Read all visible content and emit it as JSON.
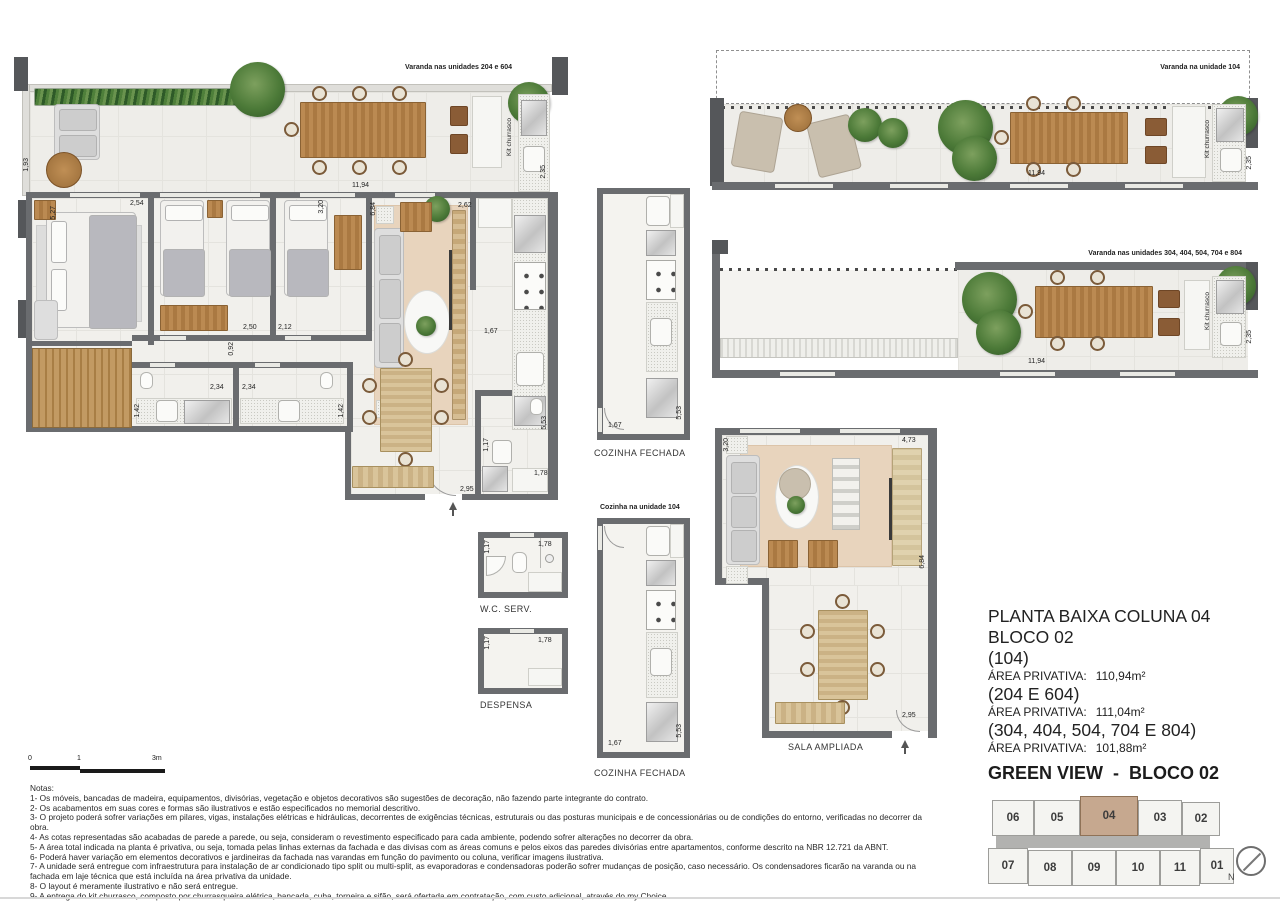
{
  "document": {
    "title_lines": [
      "PLANTA BAIXA COLUNA 04",
      "BLOCO 02"
    ],
    "units": [
      {
        "name": "(104)",
        "area_label": "ÁREA PRIVATIVA:",
        "area": "110,94m²"
      },
      {
        "name": "(204 E 604)",
        "area_label": "ÁREA PRIVATIVA:",
        "area": "111,04m²"
      },
      {
        "name": "(304, 404, 504, 704 E 804)",
        "area_label": "ÁREA PRIVATIVA:",
        "area": "101,88m²"
      }
    ],
    "project_name": "GREEN VIEW  -  BLOCO 02"
  },
  "plan_labels": {
    "varanda_204_604": "Varanda nas unidades 204 e 604",
    "varanda_104": "Varanda na unidade 104",
    "varanda_304_804": "Varanda nas unidades 304, 404, 504, 704 e 804",
    "kit_churrasco": "Kit churrasco",
    "cozinha_fechada": "COZINHA FECHADA",
    "cozinha_104": "Cozinha na unidade 104",
    "wc_serv": "W.C. SERV.",
    "despensa": "DESPENSA",
    "sala_ampliada": "SALA AMPLIADA"
  },
  "dims": {
    "main": [
      "1,93",
      "5,27",
      "2,54",
      "3,20",
      "11,94",
      "6,84",
      "2,62",
      "2,35",
      "2,50",
      "2,12",
      "0,92",
      "1,67",
      "2,34",
      "2,34",
      "1,42",
      "1,42",
      "5,53",
      "1,17",
      "1,78",
      "2,95"
    ],
    "balcony_104": [
      "11,94",
      "2,35"
    ],
    "balcony_304": [
      "11,94",
      "2,35"
    ],
    "kitchen_1": [
      "1,67",
      "5,53"
    ],
    "kitchen_2": [
      "1,67",
      "5,53"
    ],
    "wc": [
      "1,17",
      "1,78"
    ],
    "despensa": [
      "1,17",
      "1,78"
    ],
    "sala": [
      "3,20",
      "4,73",
      "6,84",
      "2,95"
    ]
  },
  "scale_bar": {
    "t0": "0",
    "t1": "1",
    "t3": "3m"
  },
  "key_plan": {
    "top_row": [
      "06",
      "05",
      "04",
      "03",
      "02"
    ],
    "bottom_row": [
      "07",
      "08",
      "09",
      "10",
      "11",
      "01"
    ],
    "highlighted_unit": "04",
    "compass_label": "N"
  },
  "notes": {
    "heading": "Notas:",
    "items": [
      "1- Os móveis, bancadas de madeira, equipamentos, divisórias, vegetação e objetos decorativos são sugestões de decoração, não fazendo parte integrante do contrato.",
      "2- Os acabamentos em suas cores e formas são ilustrativos e estão especificados no memorial descritivo.",
      "3- O projeto poderá sofrer variações em pilares, vigas, instalações elétricas e hidráulicas, decorrentes de exigências técnicas, estruturais ou das posturas municipais e de concessionárias ou de condições do entorno, verificadas no decorrer da obra.",
      "4- As cotas representadas são acabadas de parede a parede, ou seja, consideram o revestimento especificado para cada ambiente, podendo sofrer alterações no decorrer da obra.",
      "5- A área total indicada na planta é privativa, ou seja, tomada pelas linhas externas da fachada e das divisas com as áreas comuns e pelos eixos das paredes divisórias entre apartamentos, conforme descrito na NBR 12.721 da ABNT.",
      "6- Poderá haver variação em elementos decorativos e jardineiras da fachada nas varandas em função do pavimento ou coluna, verificar imagens ilustrativa.",
      "7- A unidade será entregue com infraestrutura para instalação de ar condicionado tipo split ou multi-split, as evaporadoras e condensadoras poderão sofrer mudanças de posição, caso necessário. Os condensadores ficarão na varanda ou na fachada em laje técnica que está incluída na área privativa da unidade.",
      "8- O layout é meramente ilustrativo e não será entregue.",
      "9- A entrega do kit churrasco, composto por churrasqueira elétrica, bancada, cuba, torneira e sifão, será ofertada em contratação, com custo adicional, através do my Choice."
    ]
  },
  "colors": {
    "wall": "#6a6c6f",
    "floor": "#f1f0ec",
    "wood": "#b0803f",
    "rug": "#e8d4bd",
    "plant": "#4c7a38",
    "highlighted_unit": "#c6a88f",
    "corridor": "#b2b2b0"
  }
}
